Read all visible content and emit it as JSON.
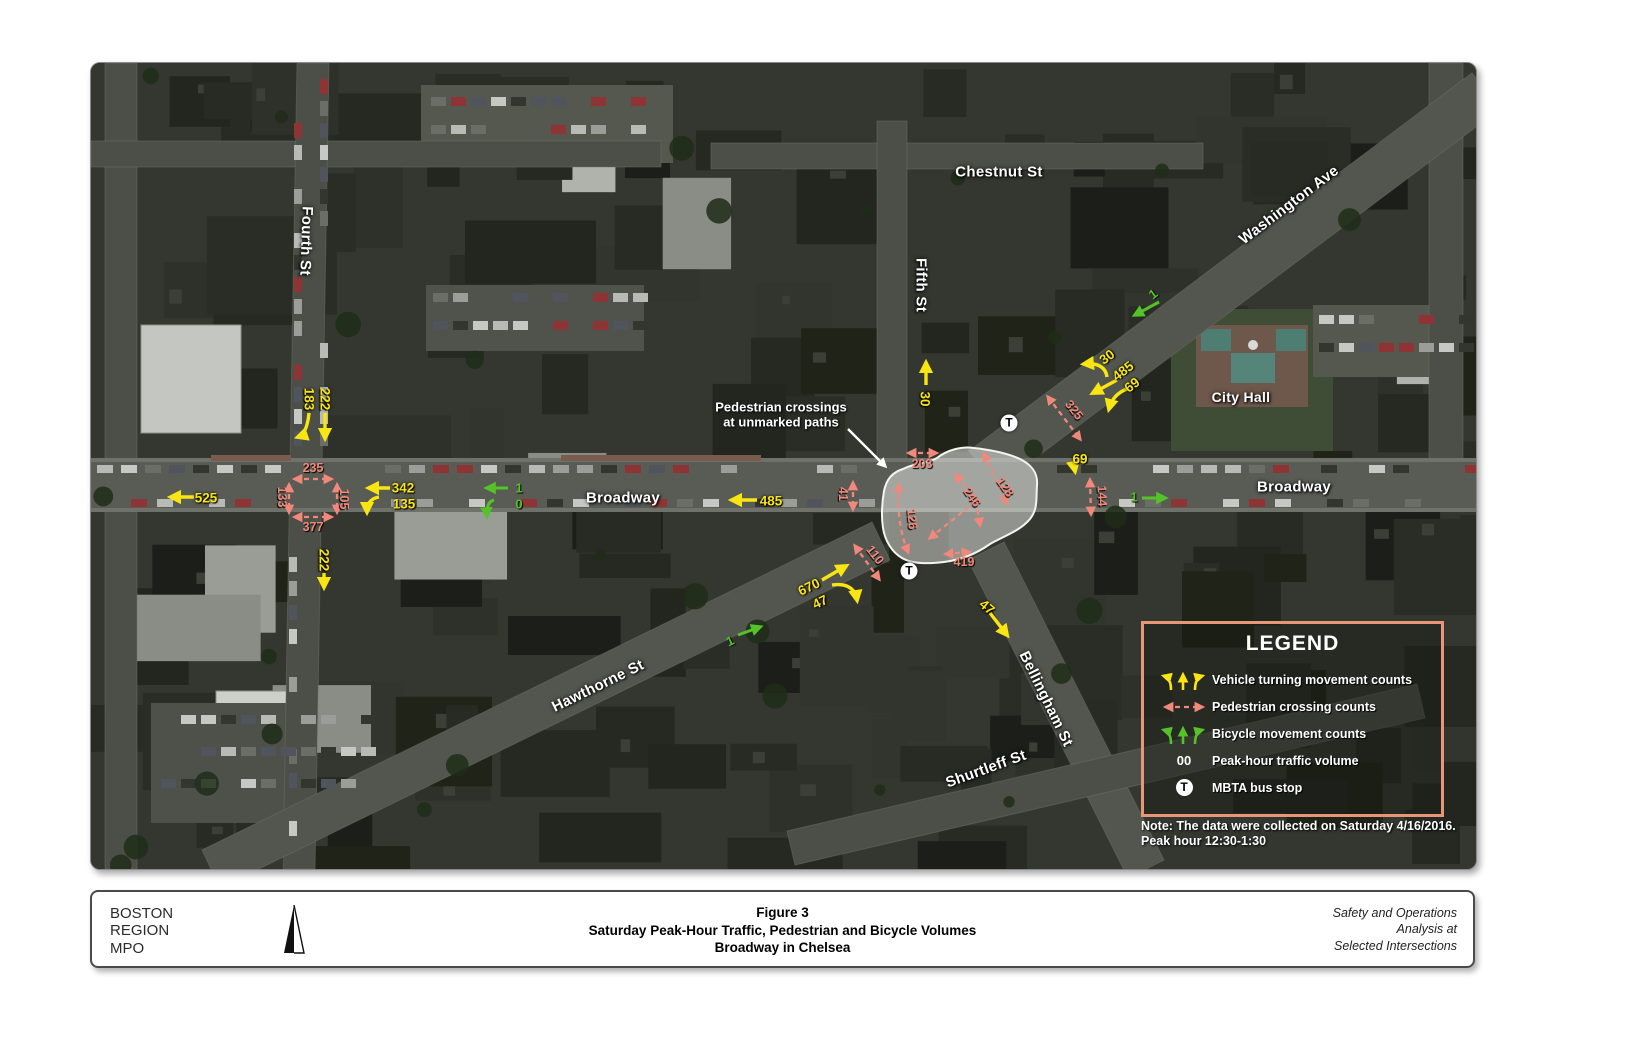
{
  "map": {
    "streets": {
      "fourth": "Fourth St",
      "chestnut": "Chestnut St",
      "fifth": "Fifth St",
      "washington": "Washington Ave",
      "city_hall": "City Hall",
      "broadway_west": "Broadway",
      "broadway_east": "Broadway",
      "hawthorne": "Hawthorne St",
      "bellingham": "Bellingham St",
      "shurtleff": "Shurtleff St"
    },
    "callout": {
      "line1": "Pedestrian crossings",
      "line2": "at unmarked paths"
    },
    "vehicle_counts": {
      "w525": "525",
      "w342": "342",
      "w135": "135",
      "n183": "183",
      "n222": "222",
      "s222": "222",
      "mid485": "485",
      "fifth30": "30",
      "h670": "670",
      "h47": "47",
      "b47": "47",
      "wa30": "30",
      "wa485": "485",
      "wa69": "69",
      "e69": "69"
    },
    "bicycle_counts": {
      "w1": "1",
      "w0": "0",
      "wa1": "1",
      "e1": "1",
      "h1": "1"
    },
    "pedestrian_counts": {
      "n235": "235",
      "w133": "133",
      "e105": "105",
      "s377": "377",
      "c41": "41",
      "c203": "203",
      "c126": "126",
      "c246": "246",
      "c128": "128",
      "c419": "419",
      "c110": "110",
      "wa325": "325",
      "e144": "144"
    },
    "bus_stop_symbol": "T"
  },
  "legend": {
    "title": "LEGEND",
    "vehicle_label": "Vehicle turning movement counts",
    "pedestrian_label": "Pedestrian crossing counts",
    "bicycle_label": "Bicycle movement counts",
    "volume_symbol": "00",
    "volume_label": "Peak-hour traffic volume",
    "mbta_label": "MBTA bus stop"
  },
  "note": {
    "line1": "Note: The data were collected on Saturday 4/16/2016.",
    "line2": "Peak hour 12:30-1:30"
  },
  "footer": {
    "org_line1": "BOSTON",
    "org_line2": "REGION",
    "org_line3": "MPO",
    "title_line1": "Figure 3",
    "title_line2": "Saturday Peak-Hour Traffic, Pedestrian and Bicycle Volumes",
    "title_line3": "Broadway in Chelsea",
    "right_line1": "Safety and Operations",
    "right_line2": "Analysis at",
    "right_line3": "Selected Intersections"
  },
  "colors": {
    "vehicle": "#f8e511",
    "bicycle": "#54c228",
    "pedestrian": "#f1887b",
    "legend_border": "#e99579"
  }
}
